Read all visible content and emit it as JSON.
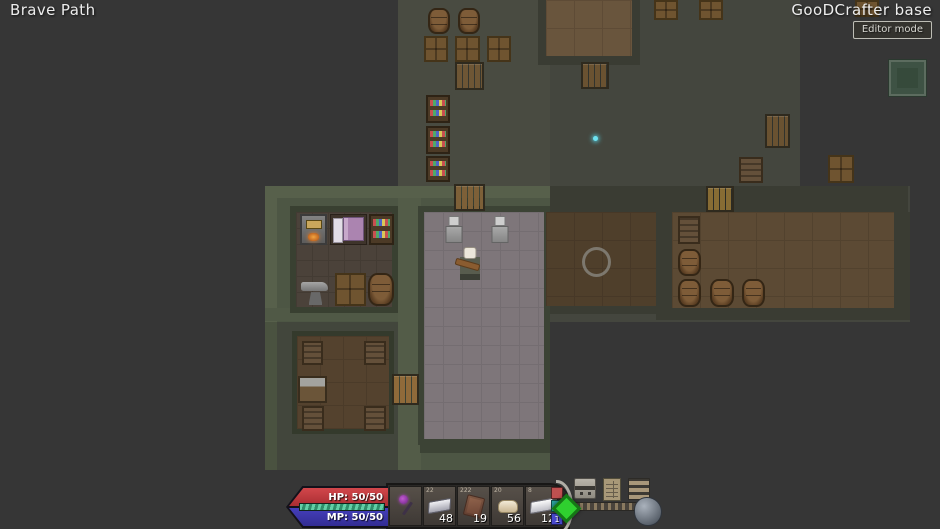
{
  "header": {
    "location": "Brave Path",
    "base_name": "GooDCrafter base",
    "editor_button": "Editor mode"
  },
  "hud": {
    "hp_label": "HP: 50/50",
    "mp_label": "MP: 50/50",
    "hp_color": "#c5383d",
    "mp_color": "#3c35ae",
    "xp_color": "#5ecba4",
    "hotbar": [
      {
        "name": "hotbar-slot-1",
        "item": "purple-mace",
        "tag": "",
        "count": ""
      },
      {
        "name": "hotbar-slot-2",
        "item": "silver-bar",
        "tag": "22",
        "count": "48"
      },
      {
        "name": "hotbar-slot-3",
        "item": "leather",
        "tag": "222",
        "count": "19"
      },
      {
        "name": "hotbar-slot-4",
        "item": "clay",
        "tag": "20",
        "count": "56"
      },
      {
        "name": "hotbar-slot-5",
        "item": "iron-bar",
        "tag": "8",
        "count": "12"
      }
    ],
    "side_buttons": [
      {
        "name": "red-marker-button",
        "label": "",
        "color": "#c05050"
      },
      {
        "name": "collapse-hotbar-button",
        "label": "«",
        "color": "#2aa39b"
      },
      {
        "name": "page-button",
        "label": "1",
        "color": "#4848cc"
      }
    ],
    "menu_icons": [
      {
        "name": "chest-icon",
        "cls": "ic-chest"
      },
      {
        "name": "ledger-icon",
        "cls": "ic-ledger"
      },
      {
        "name": "menu-icon",
        "cls": "ic-menu"
      }
    ],
    "diamond_color": "#2fd02f"
  },
  "map": {
    "objects": [
      {
        "type": "region",
        "x": 398,
        "y": 0,
        "w": 402,
        "h": 189,
        "color": "#44463e"
      },
      {
        "type": "region",
        "x": 265,
        "y": 186,
        "w": 645,
        "h": 136,
        "color": "#44463e"
      },
      {
        "type": "region",
        "x": 398,
        "y": 0,
        "w": 152,
        "h": 189,
        "color": "#494b41"
      },
      {
        "type": "region",
        "x": 265,
        "y": 322,
        "w": 285,
        "h": 148,
        "color": "#42463c"
      },
      {
        "type": "region",
        "x": 265,
        "y": 186,
        "w": 285,
        "h": 136,
        "color": "#4d5644"
      },
      {
        "type": "region",
        "x": 420,
        "y": 322,
        "w": 130,
        "h": 148,
        "color": "#4d5644"
      },
      {
        "type": "wall",
        "x": 550,
        "y": 186,
        "w": 358,
        "h": 26,
        "color": "#3a3c33"
      },
      {
        "type": "wall",
        "x": 656,
        "y": 212,
        "w": 16,
        "h": 100,
        "color": "#3a3c33"
      },
      {
        "type": "wall",
        "x": 894,
        "y": 212,
        "w": 16,
        "h": 100,
        "color": "#3a3c33"
      },
      {
        "type": "wall",
        "x": 656,
        "y": 306,
        "w": 254,
        "h": 14,
        "color": "#3a3c33"
      },
      {
        "type": "wall",
        "x": 538,
        "y": 0,
        "w": 8,
        "h": 64,
        "color": "#3a3c33"
      },
      {
        "type": "wall",
        "x": 632,
        "y": 0,
        "w": 8,
        "h": 64,
        "color": "#3a3c33"
      },
      {
        "type": "wall",
        "x": 538,
        "y": 56,
        "w": 102,
        "h": 9,
        "color": "#3a3c33"
      },
      {
        "type": "wall",
        "x": 545,
        "y": 304,
        "w": 111,
        "h": 10,
        "color": "#3a3c33"
      },
      {
        "type": "wall",
        "x": 265,
        "y": 186,
        "w": 285,
        "h": 12,
        "color": "#57604b"
      },
      {
        "type": "wall",
        "x": 265,
        "y": 186,
        "w": 12,
        "h": 136,
        "color": "#57604b"
      },
      {
        "type": "wall",
        "x": 265,
        "y": 308,
        "w": 155,
        "h": 13,
        "color": "#505946"
      },
      {
        "type": "wall",
        "x": 398,
        "y": 198,
        "w": 23,
        "h": 272,
        "color": "#535c48"
      },
      {
        "type": "wall",
        "x": 265,
        "y": 322,
        "w": 12,
        "h": 148,
        "color": "#4a5240"
      },
      {
        "type": "wall",
        "x": 420,
        "y": 440,
        "w": 130,
        "h": 13,
        "color": "#3c4335"
      },
      {
        "type": "wall",
        "x": 290,
        "y": 206,
        "w": 108,
        "h": 107,
        "color": "#394031"
      },
      {
        "type": "floor",
        "x": 296,
        "y": 212,
        "w": 96,
        "h": 95,
        "color": "#4b423a",
        "grid": "#433b33",
        "cell": 16
      },
      {
        "type": "wall",
        "x": 292,
        "y": 331,
        "w": 102,
        "h": 103,
        "color": "#343a2c"
      },
      {
        "type": "floor",
        "x": 297,
        "y": 336,
        "w": 92,
        "h": 93,
        "color": "#54422e",
        "grid": "#4b3b29",
        "cell": 23
      },
      {
        "type": "wall",
        "x": 418,
        "y": 206,
        "w": 132,
        "h": 239,
        "color": "#3c4335"
      },
      {
        "type": "floor",
        "x": 424,
        "y": 212,
        "w": 120,
        "h": 227,
        "color": "#7e767a",
        "grid": "#746d71",
        "cell": 19
      },
      {
        "type": "floor",
        "x": 546,
        "y": 0,
        "w": 86,
        "h": 56,
        "color": "#69553d",
        "grid": "#5e4b36",
        "cell": 28
      },
      {
        "type": "floor",
        "x": 546,
        "y": 212,
        "w": 110,
        "h": 94,
        "color": "#4f3f2b",
        "grid": "#473827",
        "cell": 28
      },
      {
        "type": "floor",
        "x": 672,
        "y": 212,
        "w": 222,
        "h": 96,
        "color": "#5c4a34",
        "grid": "#52422e",
        "cell": 28
      },
      {
        "type": "door",
        "x": 455,
        "y": 62,
        "w": 29,
        "h": 28,
        "wood": "#6e5635",
        "name": "wooden-door"
      },
      {
        "type": "door",
        "x": 581,
        "y": 62,
        "w": 28,
        "h": 27,
        "wood": "#6a5231",
        "name": "wooden-door"
      },
      {
        "type": "door",
        "x": 454,
        "y": 184,
        "w": 31,
        "h": 27,
        "wood": "#7d6038",
        "name": "wooden-door"
      },
      {
        "type": "door",
        "x": 392,
        "y": 374,
        "w": 27,
        "h": 31,
        "wood": "#8f6a3a",
        "name": "wooden-door"
      },
      {
        "type": "door",
        "x": 706,
        "y": 186,
        "w": 28,
        "h": 26,
        "wood": "#876c34",
        "name": "wooden-door"
      },
      {
        "type": "door",
        "x": 765,
        "y": 114,
        "w": 25,
        "h": 34,
        "wood": "#6a5231",
        "name": "wooden-door"
      },
      {
        "type": "barrel",
        "x": 428,
        "y": 8,
        "w": 22,
        "h": 26
      },
      {
        "type": "barrel",
        "x": 458,
        "y": 8,
        "w": 22,
        "h": 26
      },
      {
        "type": "crate",
        "x": 424,
        "y": 36,
        "w": 24,
        "h": 26
      },
      {
        "type": "crate",
        "x": 455,
        "y": 36,
        "w": 25,
        "h": 26
      },
      {
        "type": "crate",
        "x": 487,
        "y": 36,
        "w": 24,
        "h": 26
      },
      {
        "type": "shelf",
        "x": 426,
        "y": 95,
        "w": 24,
        "h": 28,
        "name": "potion-shelf"
      },
      {
        "type": "shelf",
        "x": 426,
        "y": 126,
        "w": 24,
        "h": 28,
        "name": "potion-shelf"
      },
      {
        "type": "shelf",
        "x": 426,
        "y": 156,
        "w": 24,
        "h": 26,
        "name": "potion-shelf"
      },
      {
        "type": "crate",
        "x": 654,
        "y": 0,
        "w": 24,
        "h": 20
      },
      {
        "type": "crate",
        "x": 699,
        "y": 0,
        "w": 24,
        "h": 20
      },
      {
        "type": "crate",
        "x": 855,
        "y": 0,
        "w": 24,
        "h": 17
      },
      {
        "type": "shelf2",
        "x": 739,
        "y": 157,
        "w": 24,
        "h": 26,
        "name": "supply-shelf"
      },
      {
        "type": "crate",
        "x": 828,
        "y": 155,
        "w": 26,
        "h": 28
      },
      {
        "type": "furnace",
        "x": 300,
        "y": 214,
        "w": 27,
        "h": 31
      },
      {
        "type": "bed",
        "x": 330,
        "y": 214,
        "w": 37,
        "h": 31
      },
      {
        "type": "shelf",
        "x": 369,
        "y": 214,
        "w": 25,
        "h": 31,
        "name": "potion-shelf"
      },
      {
        "type": "anvil",
        "x": 301,
        "y": 277,
        "w": 29,
        "h": 29
      },
      {
        "type": "crate",
        "x": 335,
        "y": 273,
        "w": 31,
        "h": 33
      },
      {
        "type": "barrel",
        "x": 368,
        "y": 273,
        "w": 26,
        "h": 33
      },
      {
        "type": "shelf2",
        "x": 302,
        "y": 341,
        "w": 21,
        "h": 24,
        "name": "supply-shelf"
      },
      {
        "type": "shelf2",
        "x": 364,
        "y": 341,
        "w": 22,
        "h": 24,
        "name": "supply-shelf"
      },
      {
        "type": "table",
        "x": 298,
        "y": 376,
        "w": 29,
        "h": 27
      },
      {
        "type": "shelf2",
        "x": 302,
        "y": 406,
        "w": 22,
        "h": 25,
        "name": "supply-shelf"
      },
      {
        "type": "shelf2",
        "x": 364,
        "y": 406,
        "w": 22,
        "h": 25,
        "name": "supply-shelf"
      },
      {
        "type": "armor-stand",
        "x": 443,
        "y": 216,
        "w": 22,
        "h": 31
      },
      {
        "type": "armor-stand",
        "x": 489,
        "y": 216,
        "w": 22,
        "h": 31
      },
      {
        "type": "player",
        "x": 460,
        "y": 247,
        "w": 20,
        "h": 33,
        "name": "player-character"
      },
      {
        "type": "shelf2",
        "x": 678,
        "y": 216,
        "w": 22,
        "h": 28,
        "name": "supply-shelf"
      },
      {
        "type": "barrel",
        "x": 678,
        "y": 249,
        "w": 23,
        "h": 27
      },
      {
        "type": "barrel",
        "x": 678,
        "y": 279,
        "w": 23,
        "h": 28
      },
      {
        "type": "barrel",
        "x": 710,
        "y": 279,
        "w": 24,
        "h": 28
      },
      {
        "type": "barrel",
        "x": 742,
        "y": 279,
        "w": 23,
        "h": 28
      },
      {
        "type": "ring",
        "x": 582,
        "y": 247,
        "w": 29,
        "h": 30,
        "name": "stone-ring"
      },
      {
        "type": "pool",
        "x": 889,
        "y": 60,
        "w": 37,
        "h": 36,
        "name": "green-pool"
      },
      {
        "type": "sparkle",
        "x": 593,
        "y": 136,
        "w": 5,
        "h": 5
      }
    ]
  }
}
